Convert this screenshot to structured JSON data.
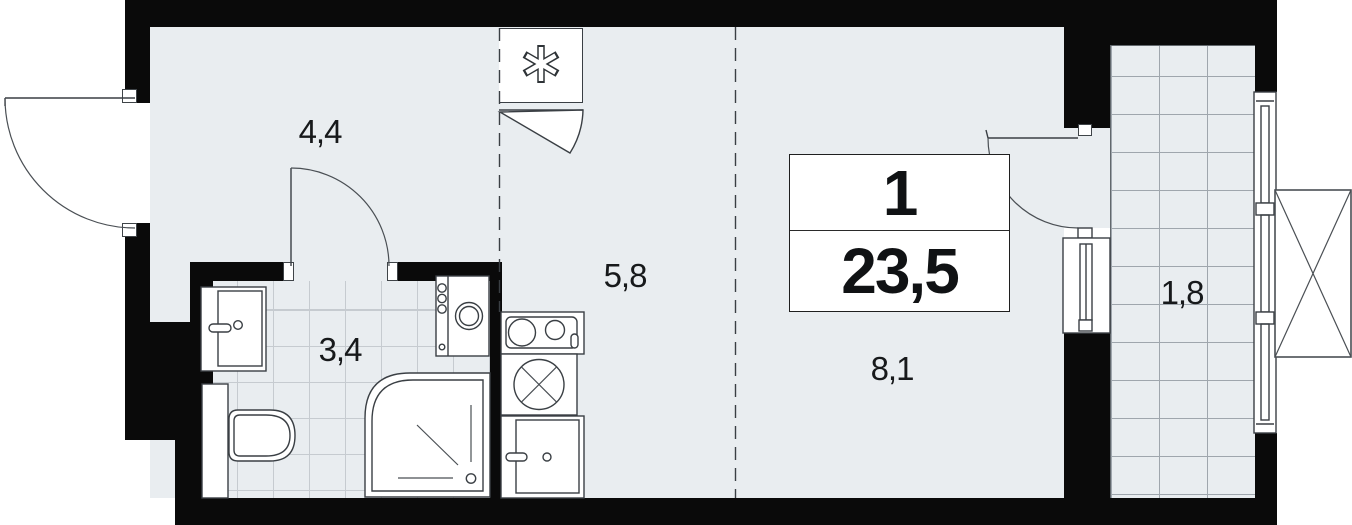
{
  "plan": {
    "unit_box": {
      "rooms_count": "1",
      "total_area": "23,5"
    },
    "labels": {
      "hallway": "4,4",
      "kitchen_zone": "5,8",
      "bathroom": "3,4",
      "living_zone": "8,1",
      "balcony": "1,8"
    },
    "icons": {
      "closet_symbol": "asterisk-icon"
    },
    "colors": {
      "wall": "#0a0a0a",
      "floor": "#e9edf0",
      "balcony_grid_line": "#9fa6ad",
      "bathroom_grid_line": "#c6cbd0",
      "line": "#3a3f44",
      "text": "#17191b"
    }
  }
}
